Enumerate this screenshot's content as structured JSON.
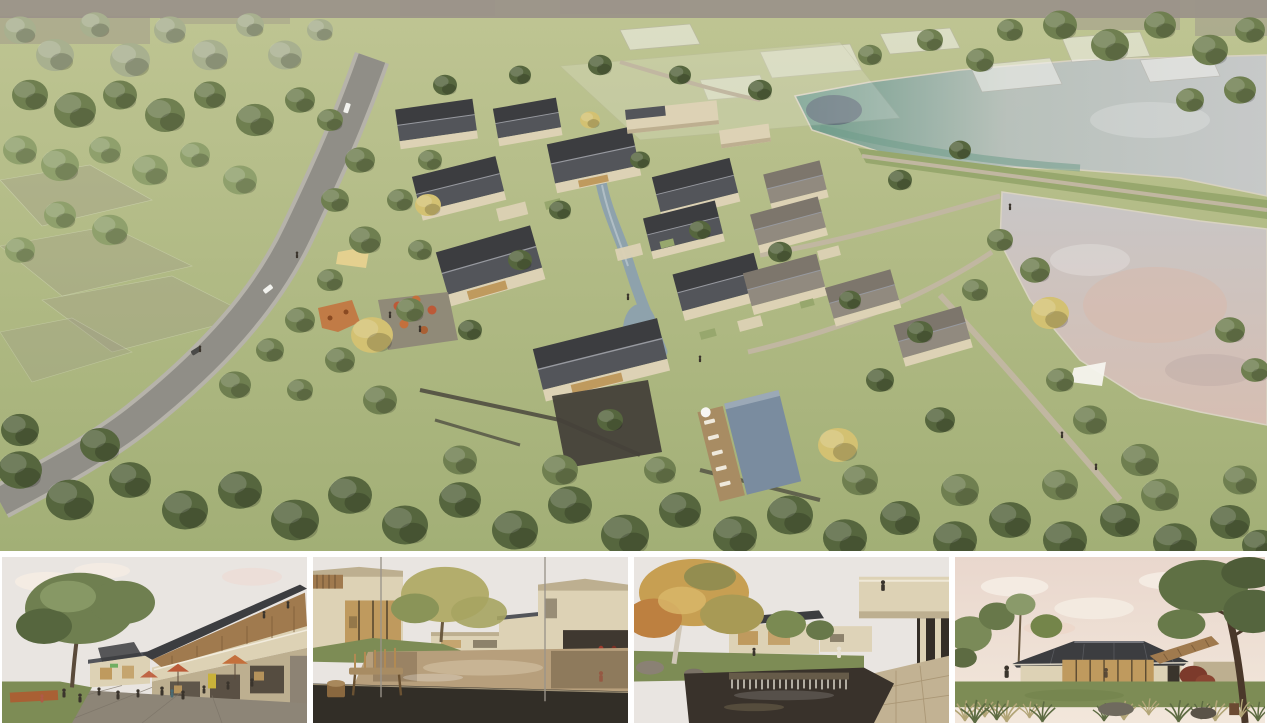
{
  "page": {
    "background": "#ffffff"
  },
  "panels": {
    "main": {
      "name": "aerial-masterplan-render"
    },
    "thumbnails": [
      {
        "name": "plaza-street-view-render"
      },
      {
        "name": "courtyard-pond-view-render"
      },
      {
        "name": "waterfall-courtyard-view-render"
      },
      {
        "name": "garden-pavilion-view-render"
      }
    ]
  },
  "palette": {
    "page-bg": "#ffffff",
    "grass-top": "#bfc593",
    "grass-bottom": "#a2af76",
    "grass-mid": "#97a76d",
    "tree-green": "#6f7f50",
    "tree-green-dark": "#56663e",
    "tree-green-light": "#8fa06c",
    "tree-sage": "#a8b08f",
    "tree-yellow": "#d3c172",
    "road": "#908e87",
    "road-edge": "#b6b3aa",
    "path-tan": "#c1b7a1",
    "roof-dark": "#3c3d40",
    "roof-mid": "#53555a",
    "roof-brown": "#7d766c",
    "roof-brown-light": "#918a7f",
    "ridge": "#97999f",
    "wall-cream": "#ddd2b5",
    "wall-shadow": "#bdaf90",
    "glass-warm": "#bf9a5e",
    "stone-dark": "#45413a",
    "stream": "#8ea2ac",
    "pool": "#7a8c9f",
    "deck-wood": "#a88c63",
    "lake-teal": "#6f9c8b",
    "lake-silver": "#c8cacb",
    "lake-pink": "#d6beb2",
    "lake-dark": "#4a4768",
    "ghost-taupe": "#9b9389",
    "canopy-yellow": "#e4d08f",
    "accent-orange": "#c4703c",
    "umbrella-red": "#bc5a38",
    "corten": "#a96034",
    "figure-dark": "#3a342c",
    "figure-red": "#9d3a2c",
    "sky-pale": "#e9e5e1",
    "cloud": "#f5ece3",
    "sky-pink-top": "#e9d7cd",
    "sky-pink-bottom": "#f2e7db",
    "pavement": "#8d8577",
    "lawn": "#7d8c55",
    "wood": "#a07a4e",
    "pond-tan": "#b79f7c",
    "pond-dark": "#6e5b42",
    "water-dark": "#39322b",
    "weir-white": "#ece7db",
    "terrace-dark": "#322e27",
    "paver": "#c2b293",
    "birch": "#cfc6b6",
    "autumn": "#c79f52",
    "autumn-orange": "#bd8040",
    "maroon": "#7c3a2b",
    "grass-tuft": "#b2a577",
    "white-soft": "#f7f6f2"
  }
}
